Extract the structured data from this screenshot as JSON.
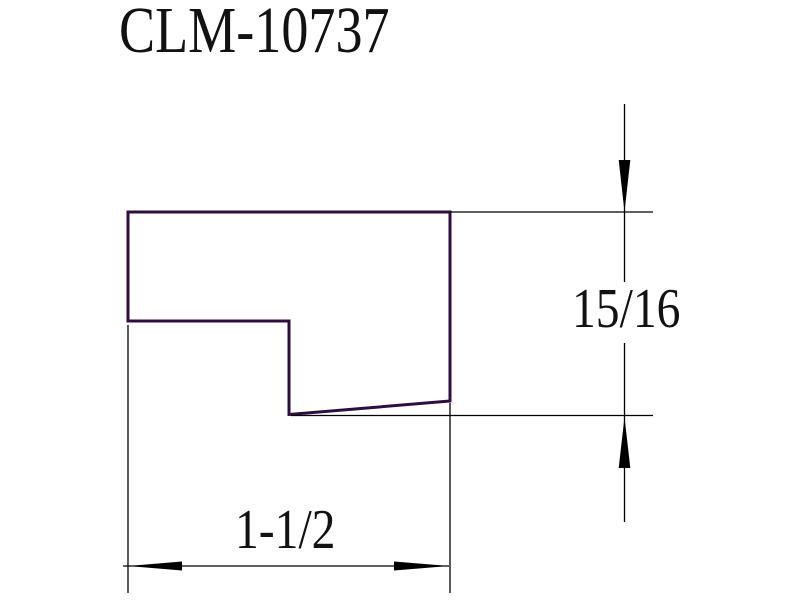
{
  "title": "CLM-10737",
  "colors": {
    "background": "#ffffff",
    "profile": "#2e0d3f",
    "dimension": "#000000",
    "text": "#121212"
  },
  "dimensions": {
    "height": {
      "label": "15/16",
      "orientation": "vertical"
    },
    "width": {
      "label": "1-1/2",
      "orientation": "horizontal"
    }
  }
}
